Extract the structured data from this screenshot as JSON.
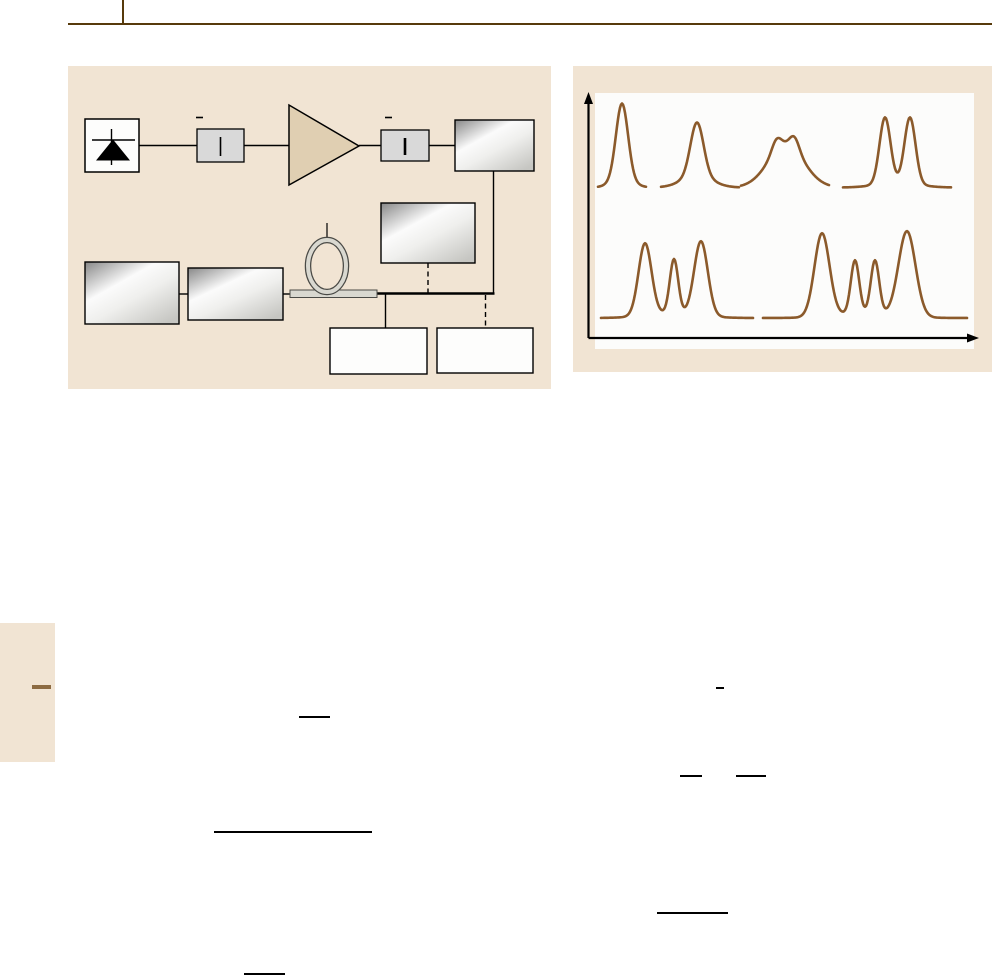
{
  "page": {
    "width": 992,
    "height": 978,
    "background": "#ffffff",
    "header": {
      "rule": {
        "x": 68,
        "y": 23,
        "width": 924,
        "height": 2
      },
      "tick": {
        "x": 122,
        "y": 0,
        "width": 2,
        "height": 25
      }
    },
    "margin_tab": {
      "block": {
        "x": 0,
        "y": 623,
        "width": 55,
        "height": 139
      },
      "dash": {
        "x": 32,
        "y": 685,
        "width": 19,
        "height": 4
      }
    },
    "stray_rules": [
      {
        "name": "overbar-small",
        "x": 716,
        "y": 687,
        "width": 8,
        "height": 1.6
      },
      {
        "name": "fraction-bar-1",
        "x": 299,
        "y": 716,
        "width": 31,
        "height": 1.7
      },
      {
        "name": "fraction-bar-2a",
        "x": 680,
        "y": 775,
        "width": 22,
        "height": 1.7
      },
      {
        "name": "fraction-bar-2b",
        "x": 736,
        "y": 775,
        "width": 30,
        "height": 1.7
      },
      {
        "name": "equation-rule",
        "x": 214,
        "y": 831,
        "width": 158,
        "height": 2
      },
      {
        "name": "fraction-bar-3",
        "x": 657,
        "y": 912,
        "width": 71,
        "height": 2
      },
      {
        "name": "fraction-bar-4",
        "x": 244,
        "y": 973,
        "width": 41,
        "height": 2.4
      }
    ]
  },
  "palette": {
    "header_brown": "#573a0c",
    "panel_beige": "#f1e4d3",
    "plot_white": "#fcfcfb",
    "line_black": "#000000",
    "box_gray": "#d9d9d9",
    "amp_tan": "#e0cfb2",
    "metal_dark": "#878787",
    "metal_hi": "#fbfbfb",
    "metal_mid": "#efefed",
    "metal_low": "#c6c6c2",
    "fiber_fill": "#d9d8d0",
    "fiber_edge": "#4a4a46",
    "white_box": "#fdfdfc",
    "curve_brown": "#8b5a2b",
    "margin_dash": "#8d6b42",
    "rule_black": "#000000"
  },
  "figure_left": {
    "panel": {
      "x": 68,
      "y": 66,
      "width": 483,
      "height": 323
    },
    "components": [
      {
        "type": "wire",
        "name": "wire-source-to-comp1",
        "x1": 71,
        "y1": 79.5,
        "x2": 129,
        "y2": 79.5
      },
      {
        "type": "wire",
        "name": "wire-comp1-to-amp",
        "x1": 176,
        "y1": 79.5,
        "x2": 221,
        "y2": 79.5
      },
      {
        "type": "wire",
        "name": "wire-amp-to-comp2",
        "x1": 291,
        "y1": 79.5,
        "x2": 313,
        "y2": 79.5
      },
      {
        "type": "wire",
        "name": "wire-comp2-to-instrument",
        "x1": 361,
        "y1": 79.5,
        "x2": 387,
        "y2": 79.5
      },
      {
        "type": "wire",
        "name": "wire-instrument-drop",
        "x1": 425.5,
        "y1": 105,
        "x2": 425.5,
        "y2": 227
      },
      {
        "type": "wire",
        "name": "wire-boxA-to-boxB",
        "x1": 111,
        "y1": 228,
        "x2": 120,
        "y2": 228
      },
      {
        "type": "wire",
        "name": "wire-boxB-to-fiber",
        "x1": 215,
        "y1": 228,
        "x2": 222,
        "y2": 228
      },
      {
        "type": "bus",
        "name": "signal-bus",
        "x1": 308,
        "y1": 227.5,
        "x2": 426.5,
        "y2": 227.5
      },
      {
        "type": "wire",
        "name": "wire-bus-to-output1",
        "x1": 317.5,
        "y1": 228,
        "x2": 317.5,
        "y2": 262
      },
      {
        "type": "dashed",
        "name": "dashed-instrument-link",
        "x1": 360,
        "y1": 197,
        "x2": 360,
        "y2": 227
      },
      {
        "type": "dashed",
        "name": "dashed-output2-link",
        "x1": 417.5,
        "y1": 229,
        "x2": 417.5,
        "y2": 262
      },
      {
        "type": "fiber",
        "name": "fiber-segment",
        "x": 222,
        "y": 224,
        "w": 87,
        "h": 7.5
      },
      {
        "type": "loop",
        "name": "fiber-loop",
        "cx": 259,
        "cy": 200,
        "rx": 19,
        "ry": 26,
        "stub_y1": 157,
        "stub_y2": 172
      },
      {
        "type": "diode-box",
        "name": "laser-diode-box",
        "x": 17,
        "y": 53,
        "w": 54,
        "h": 53
      },
      {
        "type": "dash",
        "name": "tick-comp1",
        "x": 128,
        "y": 51.5,
        "w": 7
      },
      {
        "type": "slit-box",
        "name": "inline-component-1",
        "x": 129,
        "y": 63,
        "w": 47,
        "h": 33,
        "slit_w": 1.6
      },
      {
        "type": "amp",
        "name": "amplifier-triangle",
        "points": [
          [
            221,
            39
          ],
          [
            221,
            119
          ],
          [
            291,
            80
          ]
        ]
      },
      {
        "type": "dash",
        "name": "tick-comp2",
        "x": 317,
        "y": 51.5,
        "w": 7
      },
      {
        "type": "slit-box",
        "name": "inline-component-2",
        "x": 313,
        "y": 64,
        "w": 48,
        "h": 31,
        "slit_w": 2.6
      },
      {
        "type": "metal-box",
        "name": "instrument-box-top",
        "x": 387,
        "y": 54,
        "w": 79,
        "h": 51
      },
      {
        "type": "metal-box",
        "name": "instrument-box-middle",
        "x": 313,
        "y": 137,
        "w": 94,
        "h": 60
      },
      {
        "type": "metal-box",
        "name": "instrument-box-left",
        "x": 17,
        "y": 196,
        "w": 94,
        "h": 62
      },
      {
        "type": "metal-box",
        "name": "instrument-box-left2",
        "x": 120,
        "y": 202,
        "w": 95,
        "h": 52
      },
      {
        "type": "white-box",
        "name": "output-box-1",
        "x": 262,
        "y": 262,
        "w": 97,
        "h": 46
      },
      {
        "type": "white-box",
        "name": "output-box-2",
        "x": 369,
        "y": 262,
        "w": 96,
        "h": 45
      }
    ]
  },
  "figure_right": {
    "panel": {
      "x": 573,
      "y": 66,
      "width": 419,
      "height": 306
    },
    "plot_area": {
      "x": 22,
      "y": 27,
      "width": 379,
      "height": 256
    },
    "axes": {
      "y_axis": {
        "x": 15.5,
        "y1": 272,
        "y2": 36
      },
      "x_axis": {
        "y": 272,
        "x1": 15.5,
        "x2": 396
      }
    },
    "chart_data": {
      "type": "line",
      "title": "",
      "xlabel": "",
      "ylabel": "",
      "legend": false,
      "grid": false,
      "axis_arrows": true,
      "units": "panel-relative px; each pulse is a sum of gaussian peaks (c=center, s=sigma, h=height above baseline)",
      "rows": [
        {
          "baseline": 121.5,
          "pulses": [
            {
              "name": "pulse-single-narrow",
              "x_range": [
                25,
                73
              ],
              "peaks": [
                {
                  "c": 49,
                  "s": 6,
                  "h": 76
                },
                {
                  "c": 49,
                  "s": 11,
                  "h": 8
                }
              ]
            },
            {
              "name": "pulse-single-broadened",
              "x_range": [
                88,
                166
              ],
              "peaks": [
                {
                  "c": 124,
                  "s": 6.5,
                  "h": 53
                },
                {
                  "c": 124,
                  "s": 15,
                  "h": 12
                }
              ]
            },
            {
              "name": "pulse-flat-top-ripple",
              "x_range": [
                168,
                256
              ],
              "peaks": [
                {
                  "c": 213,
                  "s": 18,
                  "h": 42
                },
                {
                  "c": 203.5,
                  "s": 4.8,
                  "h": 12
                },
                {
                  "c": 221.5,
                  "s": 4.8,
                  "h": 13
                }
              ]
            },
            {
              "name": "pulse-double-peak",
              "x_range": [
                270,
                378
              ],
              "peaks": [
                {
                  "c": 312,
                  "s": 5.5,
                  "h": 66
                },
                {
                  "c": 337,
                  "s": 5.5,
                  "h": 66
                },
                {
                  "c": 324.5,
                  "s": 20,
                  "h": 5
                }
              ]
            }
          ]
        },
        {
          "baseline": 252,
          "pulses": [
            {
              "name": "pulse-triple-peak",
              "x_range": [
                28,
                180
              ],
              "peaks": [
                {
                  "c": 72,
                  "s": 6.5,
                  "h": 72
                },
                {
                  "c": 101,
                  "s": 4.2,
                  "h": 54
                },
                {
                  "c": 128,
                  "s": 6.8,
                  "h": 74
                },
                {
                  "c": 100,
                  "s": 26,
                  "h": 5
                }
              ]
            },
            {
              "name": "pulse-quad-peak",
              "x_range": [
                190,
                394
              ],
              "peaks": [
                {
                  "c": 249,
                  "s": 7.5,
                  "h": 83
                },
                {
                  "c": 282,
                  "s": 4.2,
                  "h": 53
                },
                {
                  "c": 302,
                  "s": 4.2,
                  "h": 53
                },
                {
                  "c": 334,
                  "s": 8.5,
                  "h": 85
                },
                {
                  "c": 292,
                  "s": 30,
                  "h": 5
                }
              ]
            }
          ]
        }
      ]
    }
  }
}
